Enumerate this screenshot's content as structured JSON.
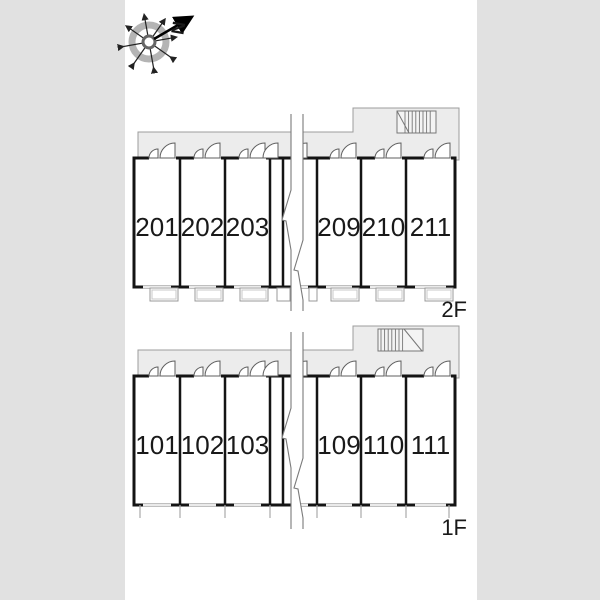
{
  "compass": {
    "north_label": "N"
  },
  "floors": [
    {
      "label": "2F",
      "rooms": [
        "201",
        "202",
        "203",
        "209",
        "210",
        "211"
      ]
    },
    {
      "label": "1F",
      "rooms": [
        "101",
        "102",
        "103",
        "109",
        "110",
        "111"
      ]
    }
  ],
  "colors": {
    "wall": "#141414",
    "corridor_fill": "#ececec"
  }
}
